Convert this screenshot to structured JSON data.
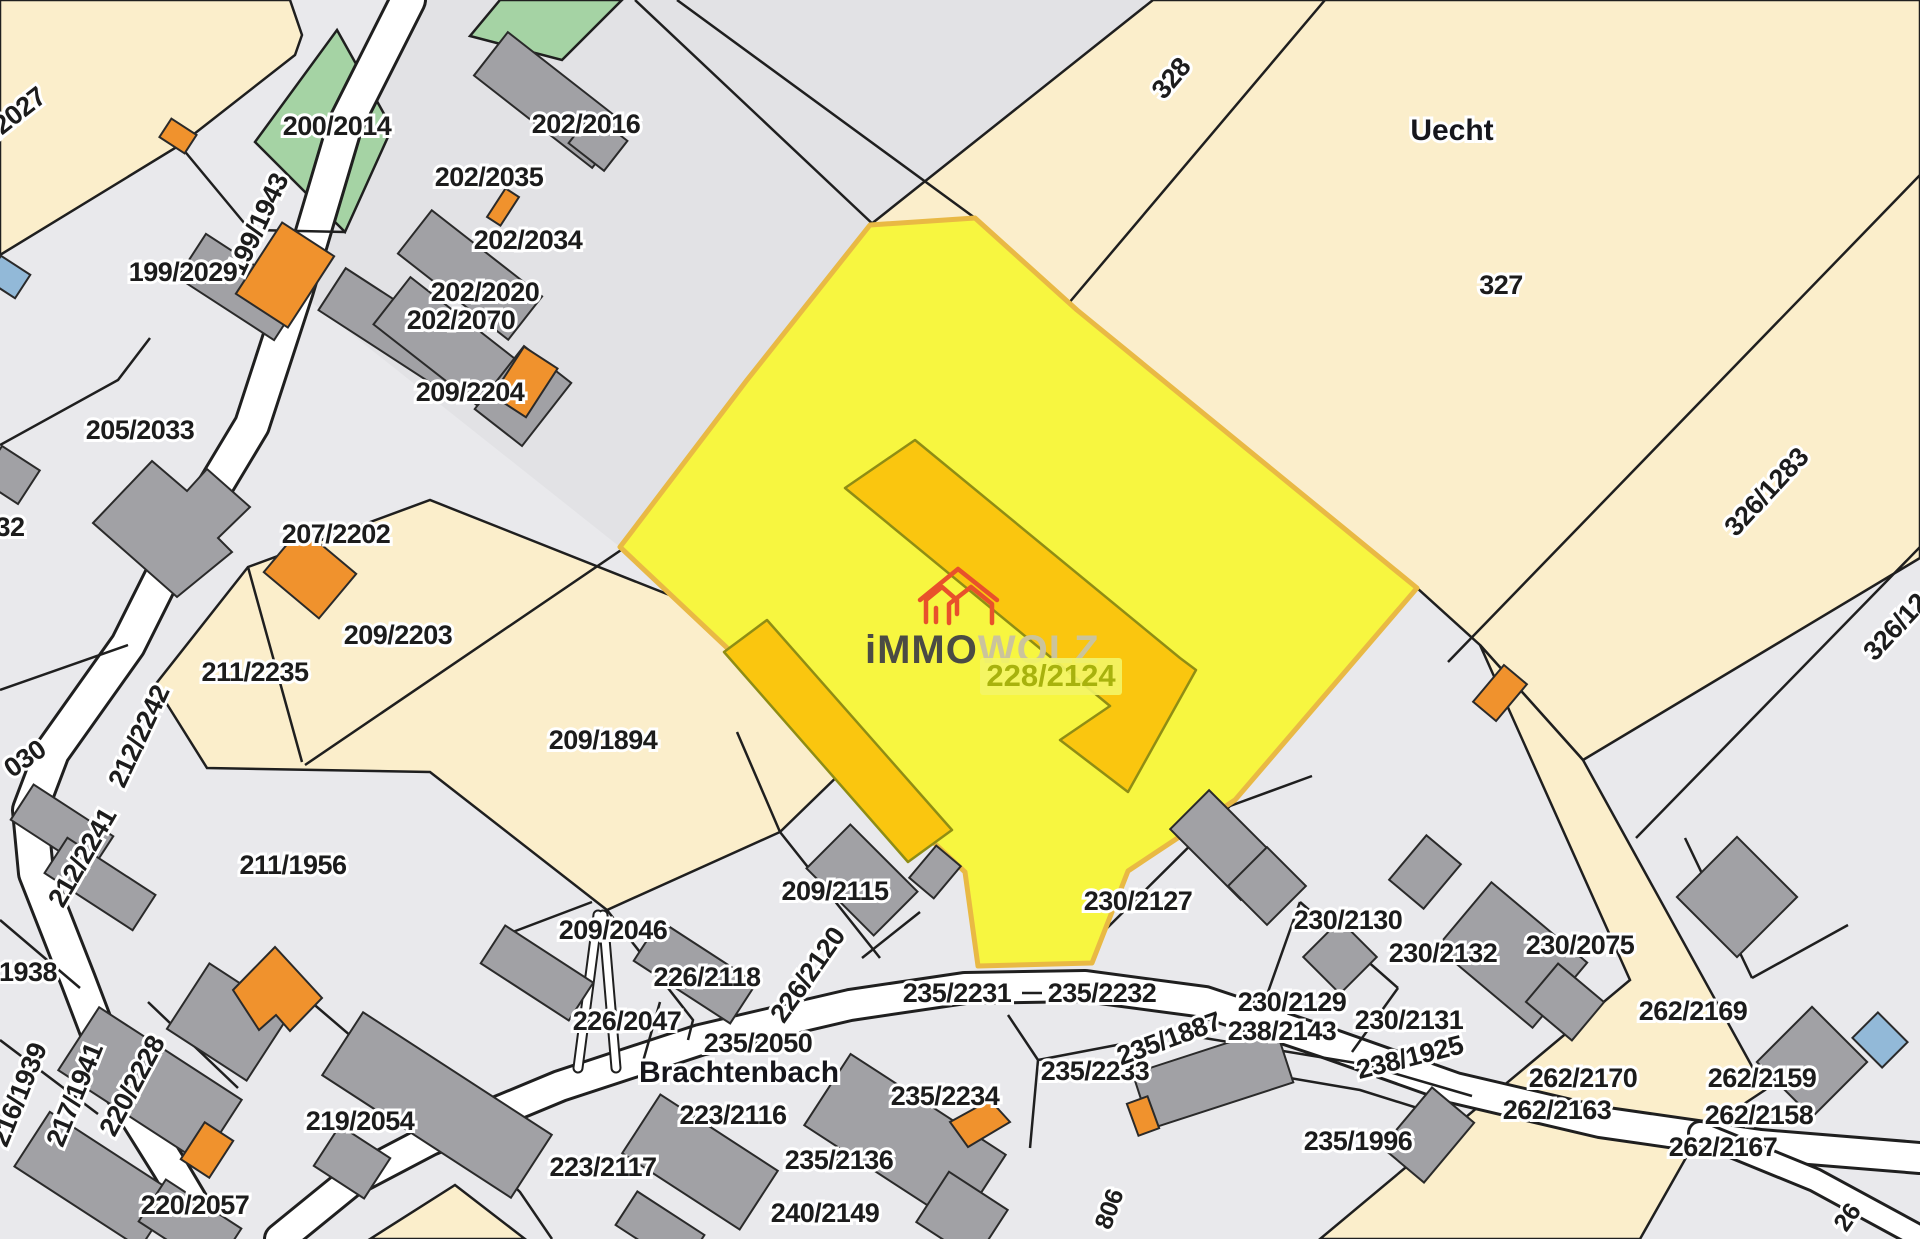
{
  "map": {
    "type": "cadastral-parcel-map",
    "highlighted_parcel": {
      "parcel_id": "228/2124"
    },
    "watermark": {
      "brand_prefix": "iMMO",
      "brand_suffix": "WOLZ",
      "parcel_label": "228/2124",
      "house_icon": "red-outline-houses"
    },
    "colors": {
      "base-gray": "#e9e9ec",
      "mid-gray": "#e2e2e5",
      "beige": "#fbeecb",
      "green": "#a5d3a4",
      "hl-yellow": "#f7f640",
      "hl-border": "#e9b944",
      "hl-bldg": "#fac60f",
      "bldg-gray": "#a1a1a5",
      "bldg-orange": "#f0922d",
      "bldg-blue": "#92b9d8",
      "line": "#1f1f1f",
      "road-white": "#ffffff",
      "logo-red": "#e8512b",
      "logo-dark": "#4b4b44",
      "logo-light": "#cbc49c",
      "wm-olive": "#a8b20d",
      "wm-tag-bg": "#f3f567"
    },
    "place_names": [
      {
        "text": "Uecht",
        "x": 1452,
        "y": 140,
        "rot": 0
      },
      {
        "text": "Brachtenbach",
        "x": 739,
        "y": 1082,
        "rot": 0
      }
    ],
    "parcel_labels": [
      {
        "text": "/2027",
        "x": 22,
        "y": 120,
        "rot": -38
      },
      {
        "text": "200/2014",
        "x": 337,
        "y": 135,
        "rot": 0
      },
      {
        "text": "202/2016",
        "x": 586,
        "y": 133,
        "rot": 0
      },
      {
        "text": "202/2035",
        "x": 489,
        "y": 186,
        "rot": 0
      },
      {
        "text": "202/2034",
        "x": 528,
        "y": 249,
        "rot": 0
      },
      {
        "text": "202/2020",
        "x": 485,
        "y": 301,
        "rot": 0
      },
      {
        "text": "202/2070",
        "x": 461,
        "y": 329,
        "rot": 0
      },
      {
        "text": "199/1943",
        "x": 266,
        "y": 228,
        "rot": -65
      },
      {
        "text": "199/2029",
        "x": 183,
        "y": 281,
        "rot": 0
      },
      {
        "text": "205/2033",
        "x": 140,
        "y": 439,
        "rot": 0
      },
      {
        "text": "32",
        "x": 10,
        "y": 536,
        "rot": 0
      },
      {
        "text": "207/2202",
        "x": 336,
        "y": 543,
        "rot": 0
      },
      {
        "text": "209/2204",
        "x": 470,
        "y": 401,
        "rot": 0
      },
      {
        "text": "209/2203",
        "x": 398,
        "y": 644,
        "rot": 0
      },
      {
        "text": "211/2235",
        "x": 255,
        "y": 681,
        "rot": 0
      },
      {
        "text": "212/2242",
        "x": 147,
        "y": 740,
        "rot": -65
      },
      {
        "text": "030",
        "x": 30,
        "y": 766,
        "rot": -35
      },
      {
        "text": "212/2241",
        "x": 90,
        "y": 862,
        "rot": -60
      },
      {
        "text": "211/1956",
        "x": 293,
        "y": 874,
        "rot": 0
      },
      {
        "text": "1938",
        "x": 28,
        "y": 981,
        "rot": 0
      },
      {
        "text": "216/1939",
        "x": 27,
        "y": 1098,
        "rot": -68
      },
      {
        "text": "217/1941",
        "x": 83,
        "y": 1098,
        "rot": -68
      },
      {
        "text": "220/2228",
        "x": 140,
        "y": 1090,
        "rot": -62
      },
      {
        "text": "220/2057",
        "x": 195,
        "y": 1214,
        "rot": 0
      },
      {
        "text": "219/2054",
        "x": 360,
        "y": 1130,
        "rot": 0
      },
      {
        "text": "209/1894",
        "x": 603,
        "y": 749,
        "rot": 0
      },
      {
        "text": "209/2115",
        "x": 835,
        "y": 900,
        "rot": 0
      },
      {
        "text": "209/2046",
        "x": 613,
        "y": 939,
        "rot": 0
      },
      {
        "text": "226/2118",
        "x": 707,
        "y": 986,
        "rot": 0
      },
      {
        "text": "226/2120",
        "x": 815,
        "y": 980,
        "rot": -55
      },
      {
        "text": "226/2047",
        "x": 627,
        "y": 1030,
        "rot": 0
      },
      {
        "text": "235/2050",
        "x": 758,
        "y": 1052,
        "rot": 0
      },
      {
        "text": "223/2116",
        "x": 733,
        "y": 1124,
        "rot": 0
      },
      {
        "text": "223/2117",
        "x": 603,
        "y": 1176,
        "rot": 0
      },
      {
        "text": "235/2136",
        "x": 839,
        "y": 1169,
        "rot": 0
      },
      {
        "text": "240/2149",
        "x": 825,
        "y": 1222,
        "rot": 0
      },
      {
        "text": "235/2231",
        "x": 957,
        "y": 1002,
        "rot": 0
      },
      {
        "text": "235/2232",
        "x": 1102,
        "y": 1002,
        "rot": 0
      },
      {
        "text": "235/2233",
        "x": 1095,
        "y": 1080,
        "rot": 0
      },
      {
        "text": "235/2234",
        "x": 945,
        "y": 1105,
        "rot": 0
      },
      {
        "text": "235/1887",
        "x": 1172,
        "y": 1047,
        "rot": -20
      },
      {
        "text": "230/2127",
        "x": 1138,
        "y": 910,
        "rot": 0
      },
      {
        "text": "230/2129",
        "x": 1292,
        "y": 1011,
        "rot": 0
      },
      {
        "text": "238/2143",
        "x": 1282,
        "y": 1040,
        "rot": 0
      },
      {
        "text": "230/2130",
        "x": 1348,
        "y": 929,
        "rot": 0
      },
      {
        "text": "230/2131",
        "x": 1409,
        "y": 1029,
        "rot": 0
      },
      {
        "text": "230/2132",
        "x": 1443,
        "y": 962,
        "rot": 0
      },
      {
        "text": "230/2075",
        "x": 1580,
        "y": 954,
        "rot": 0
      },
      {
        "text": "238/1925",
        "x": 1412,
        "y": 1066,
        "rot": -14
      },
      {
        "text": "235/1996",
        "x": 1358,
        "y": 1150,
        "rot": 0
      },
      {
        "text": "262/2169",
        "x": 1693,
        "y": 1020,
        "rot": 0
      },
      {
        "text": "262/2170",
        "x": 1583,
        "y": 1087,
        "rot": 0
      },
      {
        "text": "262/2163",
        "x": 1557,
        "y": 1119,
        "rot": 0
      },
      {
        "text": "262/2159",
        "x": 1762,
        "y": 1087,
        "rot": 0
      },
      {
        "text": "262/2158",
        "x": 1759,
        "y": 1124,
        "rot": 0
      },
      {
        "text": "262/2167",
        "x": 1723,
        "y": 1156,
        "rot": 0
      },
      {
        "text": "328",
        "x": 1178,
        "y": 84,
        "rot": -50
      },
      {
        "text": "327",
        "x": 1501,
        "y": 294,
        "rot": 0
      },
      {
        "text": "326/1283",
        "x": 1773,
        "y": 498,
        "rot": -47
      },
      {
        "text": "326/12",
        "x": 1902,
        "y": 633,
        "rot": -47
      },
      {
        "text": "806",
        "x": 1117,
        "y": 1212,
        "rot": -70,
        "size": "small"
      },
      {
        "text": "26",
        "x": 1854,
        "y": 1222,
        "rot": -55,
        "size": "small"
      }
    ]
  }
}
